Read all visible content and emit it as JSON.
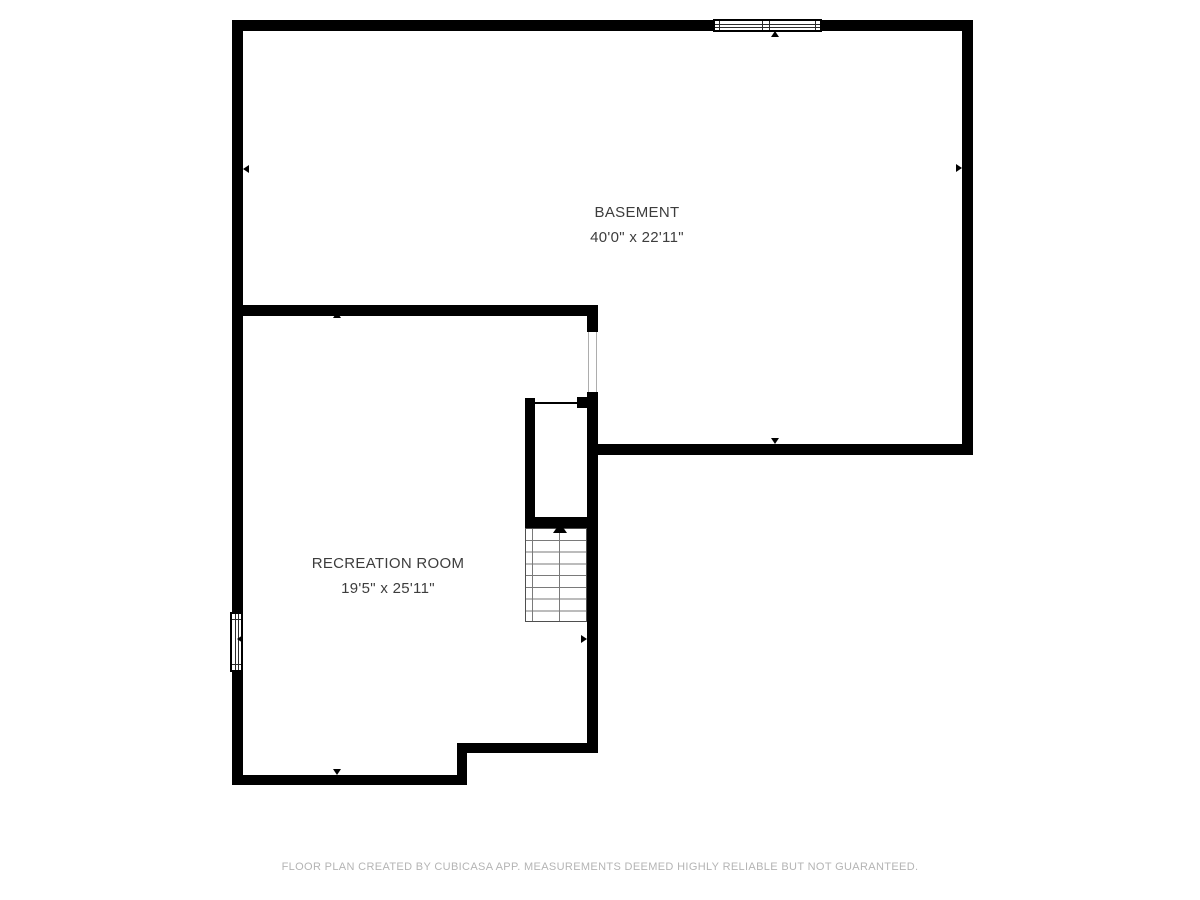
{
  "page": {
    "background": "#ffffff"
  },
  "rooms": [
    {
      "name": "BASEMENT",
      "dimensions": "40'0\" x 22'11\""
    },
    {
      "name": "RECREATION ROOM",
      "dimensions": "19'5\" x 25'11\""
    }
  ],
  "footer": {
    "disclaimer": "FLOOR PLAN CREATED BY CUBICASA APP. MEASUREMENTS DEEMED HIGHLY RELIABLE BUT NOT GUARANTEED."
  },
  "colors": {
    "wall": "#000000",
    "room_text": "#3d3d3d",
    "footer_text": "#b4b4b4",
    "stair_lines": "#7a7a7a",
    "window_frame": "#000000",
    "background": "#ffffff"
  },
  "icons": {
    "stairs-up-arrow-icon": "▲ (direction of stairs, filled triangle)",
    "opening-marker-up-icon": "▲",
    "opening-marker-down-icon": "▼",
    "opening-marker-left-icon": "◀",
    "opening-marker-right-icon": "▶"
  }
}
